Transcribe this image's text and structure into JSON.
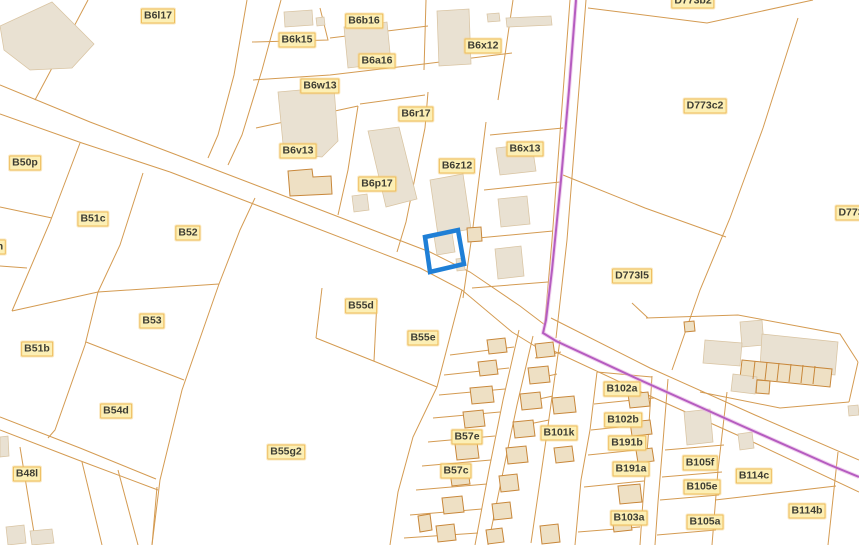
{
  "map": {
    "width": 859,
    "height": 545,
    "background": "#ffffff",
    "colors": {
      "parcel_line": "#d49b52",
      "building_fill": "#e9e1d2",
      "building_stroke": "#d9c4a2",
      "outlined_building_fill": "#eee0c4",
      "outlined_building_stroke": "#c8873a",
      "admin_line": "#b55cc0",
      "admin_halo": "#e5aee2",
      "selection": "#1f7fd6",
      "label_bg": "#fcefb5",
      "label_border": "#eebd5c",
      "label_text": "#3d3d33"
    },
    "selected_parcel": {
      "points": "425,237 458,230 464,264 430,272"
    },
    "admin_boundary": {
      "points": "576,0 569,90 561,180 552,270 546,320 543,333 556,341 640,380 740,425 830,465 859,477"
    },
    "parcel_labels": [
      {
        "text": "B6l17",
        "x": 158,
        "y": 16
      },
      {
        "text": "B6b16",
        "x": 364,
        "y": 21
      },
      {
        "text": "B6k15",
        "x": 297,
        "y": 40
      },
      {
        "text": "B6a16",
        "x": 377,
        "y": 61
      },
      {
        "text": "B6x12",
        "x": 483,
        "y": 46
      },
      {
        "text": "B6w13",
        "x": 320,
        "y": 86
      },
      {
        "text": "B6r17",
        "x": 416,
        "y": 114
      },
      {
        "text": "B6v13",
        "x": 298,
        "y": 151
      },
      {
        "text": "B6z12",
        "x": 457,
        "y": 166
      },
      {
        "text": "B6x13",
        "x": 525,
        "y": 149
      },
      {
        "text": "B6p17",
        "x": 377,
        "y": 184
      },
      {
        "text": "D773b2",
        "x": 693,
        "y": 1
      },
      {
        "text": "D773c2",
        "x": 705,
        "y": 106
      },
      {
        "text": "D773",
        "x": 851,
        "y": 213
      },
      {
        "text": "D773l5",
        "x": 632,
        "y": 276
      },
      {
        "text": "B50p",
        "x": 25,
        "y": 163
      },
      {
        "text": "B51c",
        "x": 93,
        "y": 219
      },
      {
        "text": "B52",
        "x": 188,
        "y": 233
      },
      {
        "text": "n",
        "x": 0,
        "y": 247
      },
      {
        "text": "B51b",
        "x": 37,
        "y": 349
      },
      {
        "text": "B53",
        "x": 152,
        "y": 321
      },
      {
        "text": "B54d",
        "x": 116,
        "y": 411
      },
      {
        "text": "B48l",
        "x": 27,
        "y": 474
      },
      {
        "text": "B55d",
        "x": 361,
        "y": 306
      },
      {
        "text": "B55e",
        "x": 423,
        "y": 338
      },
      {
        "text": "B55g2",
        "x": 286,
        "y": 452
      },
      {
        "text": "B57e",
        "x": 467,
        "y": 437
      },
      {
        "text": "B57c",
        "x": 456,
        "y": 471
      },
      {
        "text": "B101k",
        "x": 559,
        "y": 433
      },
      {
        "text": "B102a",
        "x": 622,
        "y": 389
      },
      {
        "text": "B102b",
        "x": 623,
        "y": 420
      },
      {
        "text": "B191b",
        "x": 627,
        "y": 443
      },
      {
        "text": "B191a",
        "x": 631,
        "y": 469
      },
      {
        "text": "B103a",
        "x": 629,
        "y": 518
      },
      {
        "text": "B105f",
        "x": 700,
        "y": 463
      },
      {
        "text": "B105e",
        "x": 702,
        "y": 487
      },
      {
        "text": "B105a",
        "x": 705,
        "y": 522
      },
      {
        "text": "B114c",
        "x": 754,
        "y": 476
      },
      {
        "text": "B114b",
        "x": 807,
        "y": 511
      }
    ],
    "parcel_lines": [
      "0,85 90,122 177,155",
      "0,114 82,143 170,172",
      "177,155 300,202 430,252 470,272 520,306 545,325",
      "170,172 290,218 420,268 462,290 512,332 538,348",
      "247,0 234,75 218,135 208,158",
      "281,0 262,70 242,135 228,165",
      "551,318 650,368 755,415 859,460",
      "543,346 650,396 755,443 859,492",
      "519,330 503,400 489,470 475,545",
      "533,336 517,405 503,472 488,545",
      "652,376 648,440 643,500 640,545",
      "668,379 663,442 658,502 655,545",
      "0,417 80,448 156,479",
      "0,430 78,460 158,490",
      "157,487 152,545",
      "80,143 50,222 12,311",
      "0,207 52,218",
      "0,266 27,268",
      "12,311 98,292",
      "143,173 120,245 98,292",
      "98,292 85,345 55,430 48,438",
      "255,198 240,230 219,284 182,390 160,480 152,545",
      "98,292 219,284",
      "86,342 184,380",
      "20,447 36,545",
      "82,462 102,545",
      "118,470 138,545",
      "322,288 316,338",
      "316,338 376,362 437,387",
      "377,300 374,361",
      "462,290 437,387",
      "437,387 413,437 398,492 390,545",
      "450,355 514,347",
      "444,375 509,368",
      "439,395 505,389",
      "433,418 500,412",
      "428,442 495,436",
      "422,466 491,460",
      "416,490 487,484",
      "410,515 482,509",
      "404,538 478,533",
      "560,340 546,440 531,543",
      "535,358 561,352",
      "530,380 557,374",
      "525,402 553,396",
      "519,426 549,420",
      "597,372 590,430 581,480 575,545",
      "597,372 652,377",
      "594,404 654,398",
      "591,430 650,424",
      "588,455 647,449",
      "584,487 644,481",
      "578,532 640,527",
      "727,392 718,470 712,545",
      "665,450 724,445",
      "662,477 722,472",
      "660,500 719,495",
      "657,535 716,530",
      "838,452 828,545",
      "715,500 836,486",
      "570,0 552,240 544,332",
      "586,0 567,240 556,338",
      "563,175 645,208 726,237",
      "588,8 707,23 813,0",
      "798,18 763,128 730,218 700,290 672,370",
      "646,318 738,315 840,334 858,362",
      "858,362 849,402",
      "849,402 780,408 700,392",
      "648,318 632,303",
      "486,122 472,235 463,298",
      "490,135 563,128",
      "484,190 560,182",
      "478,238 553,231",
      "472,288 548,282",
      "425,128 406,222 397,252",
      "252,42 328,40 320,8",
      "330,38 428,26",
      "426,0 424,70",
      "253,80 330,75 424,64 512,53",
      "513,0 505,55 498,100",
      "256,128 358,106",
      "358,106 348,170 338,215",
      "360,104 425,95",
      "428,92 425,128",
      "88,0 52,68 35,100"
    ],
    "building_dividers": [
      "755,361 753,379",
      "767,362 765,380",
      "779,363 777,381",
      "791,364 789,382",
      "803,365 801,383",
      "815,366 813,384"
    ],
    "buildings": [
      {
        "p": "0,26 52,2 94,44 72,68 30,70 4,50",
        "o": false
      },
      {
        "p": "284,12 312,10 313,25 285,27",
        "o": false
      },
      {
        "p": "316,18 324,17 325,25 317,26",
        "o": false
      },
      {
        "p": "344,27 387,22 391,63 348,68",
        "o": false
      },
      {
        "p": "437,11 469,9 471,64 439,66",
        "o": false
      },
      {
        "p": "487,14 499,13 500,21 488,22",
        "o": false
      },
      {
        "p": "506,18 551,16 552,25 507,27",
        "o": false
      },
      {
        "p": "278,92 334,87 338,141 322,157 284,154",
        "o": false
      },
      {
        "p": "368,131 399,127 417,199 386,207",
        "o": false
      },
      {
        "p": "352,196 367,194 369,210 354,212",
        "o": false
      },
      {
        "p": "288,171 312,169 313,177 331,176 332,194 290,196",
        "o": true
      },
      {
        "p": "430,180 463,174 471,229 438,235",
        "o": false
      },
      {
        "p": "434,236 452,233 455,252 437,255",
        "o": false
      },
      {
        "p": "467,228 481,227 482,241 468,242",
        "o": true
      },
      {
        "p": "456,259 464,258 465,270 457,271",
        "o": false
      },
      {
        "p": "496,148 532,144 536,171 500,175",
        "o": false
      },
      {
        "p": "498,199 527,196 530,224 501,227",
        "o": false
      },
      {
        "p": "495,249 521,246 524,276 498,279",
        "o": false
      },
      {
        "p": "740,322 762,320 764,345 742,347",
        "o": false
      },
      {
        "p": "762,334 838,342 835,375 760,368",
        "o": false
      },
      {
        "p": "705,340 742,343 740,366 703,363",
        "o": false
      },
      {
        "p": "742,360 832,369 830,387 740,378",
        "o": true
      },
      {
        "p": "733,374 757,377 755,394 731,391",
        "o": false
      },
      {
        "p": "757,380 770,381 769,394 756,393",
        "o": true
      },
      {
        "p": "684,322 694,321 695,331 685,332",
        "o": true
      },
      {
        "p": "848,406 858,405 859,415 849,416",
        "o": false
      },
      {
        "p": "487,340 505,338 507,352 489,354",
        "o": true
      },
      {
        "p": "478,362 496,360 498,374 480,376",
        "o": true
      },
      {
        "p": "470,388 492,386 494,402 472,404",
        "o": true
      },
      {
        "p": "463,412 483,410 485,426 465,428",
        "o": true
      },
      {
        "p": "455,444 477,442 479,458 457,460",
        "o": true
      },
      {
        "p": "450,472 468,470 470,484 452,486",
        "o": true
      },
      {
        "p": "442,498 462,496 464,512 444,514",
        "o": true
      },
      {
        "p": "436,526 454,524 456,540 438,542",
        "o": true
      },
      {
        "p": "418,516 430,514 432,530 420,532",
        "o": true
      },
      {
        "p": "535,344 553,342 555,356 537,358",
        "o": true
      },
      {
        "p": "528,368 548,366 550,382 530,384",
        "o": true
      },
      {
        "p": "520,394 540,392 542,408 522,410",
        "o": true
      },
      {
        "p": "513,422 533,420 535,436 515,438",
        "o": true
      },
      {
        "p": "506,448 526,446 528,462 508,464",
        "o": true
      },
      {
        "p": "499,476 517,474 519,490 501,492",
        "o": true
      },
      {
        "p": "492,504 510,502 512,518 494,520",
        "o": true
      },
      {
        "p": "486,530 502,528 504,542 488,544",
        "o": true
      },
      {
        "p": "628,394 648,392 650,406 630,408",
        "o": true
      },
      {
        "p": "630,422 650,420 652,434 632,436",
        "o": true
      },
      {
        "p": "636,450 652,448 654,461 638,463",
        "o": true
      },
      {
        "p": "618,486 640,484 642,502 620,504",
        "o": true
      },
      {
        "p": "612,517 630,515 632,530 614,532",
        "o": true
      },
      {
        "p": "552,398 574,396 576,412 554,414",
        "o": true
      },
      {
        "p": "554,448 572,446 574,461 556,463",
        "o": true
      },
      {
        "p": "540,526 558,524 560,542 542,544",
        "o": true
      },
      {
        "p": "684,412 710,409 713,442 687,445",
        "o": false
      },
      {
        "p": "738,434 752,432 754,448 740,450",
        "o": false
      },
      {
        "p": "6,527 24,525 26,543 8,545",
        "o": false
      },
      {
        "p": "30,531 52,529 54,543 32,545",
        "o": false
      },
      {
        "p": "0,437 8,436 9,456 0,457",
        "o": false
      }
    ]
  }
}
